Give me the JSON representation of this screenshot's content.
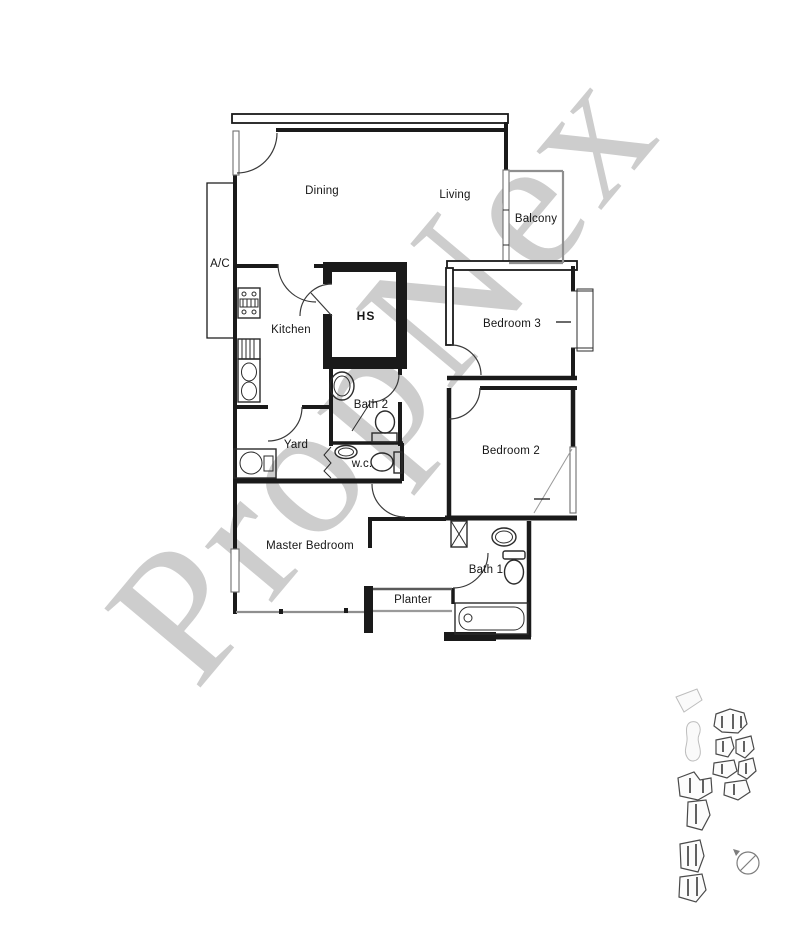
{
  "watermark": {
    "text": "PropNex",
    "color_hint": "#cdcdcd"
  },
  "floor_plan": {
    "rooms": {
      "dining": "Dining",
      "living": "Living",
      "balcony": "Balcony",
      "ac_ledge": "A/C",
      "kitchen": "Kitchen",
      "hs": "HS",
      "bedroom3": "Bedroom 3",
      "bath2": "Bath 2",
      "yard": "Yard",
      "bedroom2": "Bedroom 2",
      "wc": "w.c.",
      "master_bedroom": "Master Bedroom",
      "bath1": "Bath 1",
      "planter": "Planter"
    },
    "fixtures": [
      "stove",
      "kitchen-sink",
      "counter",
      "washing-machine",
      "wash-basin",
      "toilet",
      "bathtub",
      "shower-screen",
      "household-shelter",
      "door-swing",
      "window",
      "duct-shaft"
    ]
  },
  "site_plan": {
    "compass": "north-indicator",
    "content": "building block cluster thumbnail"
  },
  "colors": {
    "wall": "#1a1a1a",
    "door": "#3a3a3a",
    "light-line": "#8f8f8f",
    "watermark": "#cdcdcd",
    "label": "#161616",
    "site-line": "#4a4a4a"
  }
}
